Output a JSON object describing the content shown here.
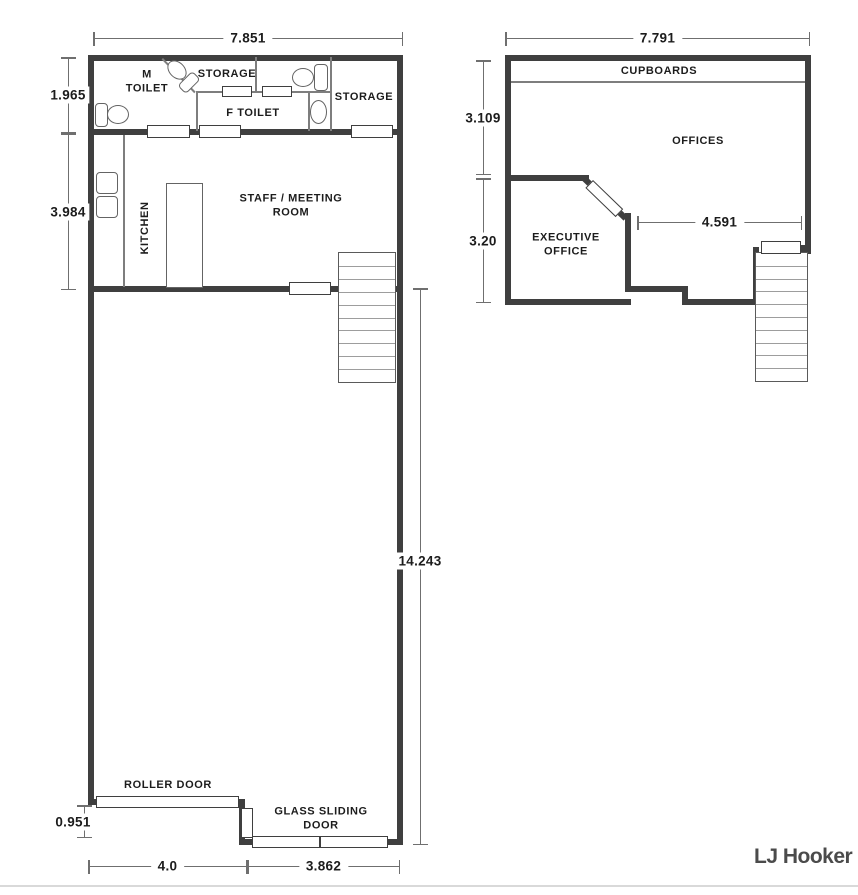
{
  "meta": {
    "brand_logo": "LJ Hooker",
    "wall_color": "#3f3f3f",
    "dimension_line_color": "#6f6f6f",
    "text_color": "#1c1c1c",
    "logo_color": "#4b4b4b"
  },
  "ground_floor": {
    "rooms": {
      "m_toilet": "M TOILET",
      "storage_top": "STORAGE",
      "f_toilet": "F TOILET",
      "storage_right": "STORAGE",
      "kitchen": "KITCHEN",
      "staff_meeting_room": "STAFF / MEETING ROOM",
      "roller_door": "ROLLER DOOR",
      "glass_sliding_door": "GLASS SLIDING DOOR"
    },
    "dimensions": {
      "overall_width": "7.851",
      "toilet_band_depth": "1.965",
      "kitchen_depth": "3.984",
      "warehouse_length": "14.243",
      "rear_offset": "0.951",
      "roller_door_width": "4.0",
      "glass_door_width": "3.862"
    }
  },
  "upper_floor": {
    "rooms": {
      "cupboards": "CUPBOARDS",
      "offices": "OFFICES",
      "executive_office": "EXECUTIVE OFFICE"
    },
    "dimensions": {
      "overall_width": "7.791",
      "offices_depth": "3.109",
      "executive_depth": "3.20",
      "offices_width": "4.591"
    }
  }
}
